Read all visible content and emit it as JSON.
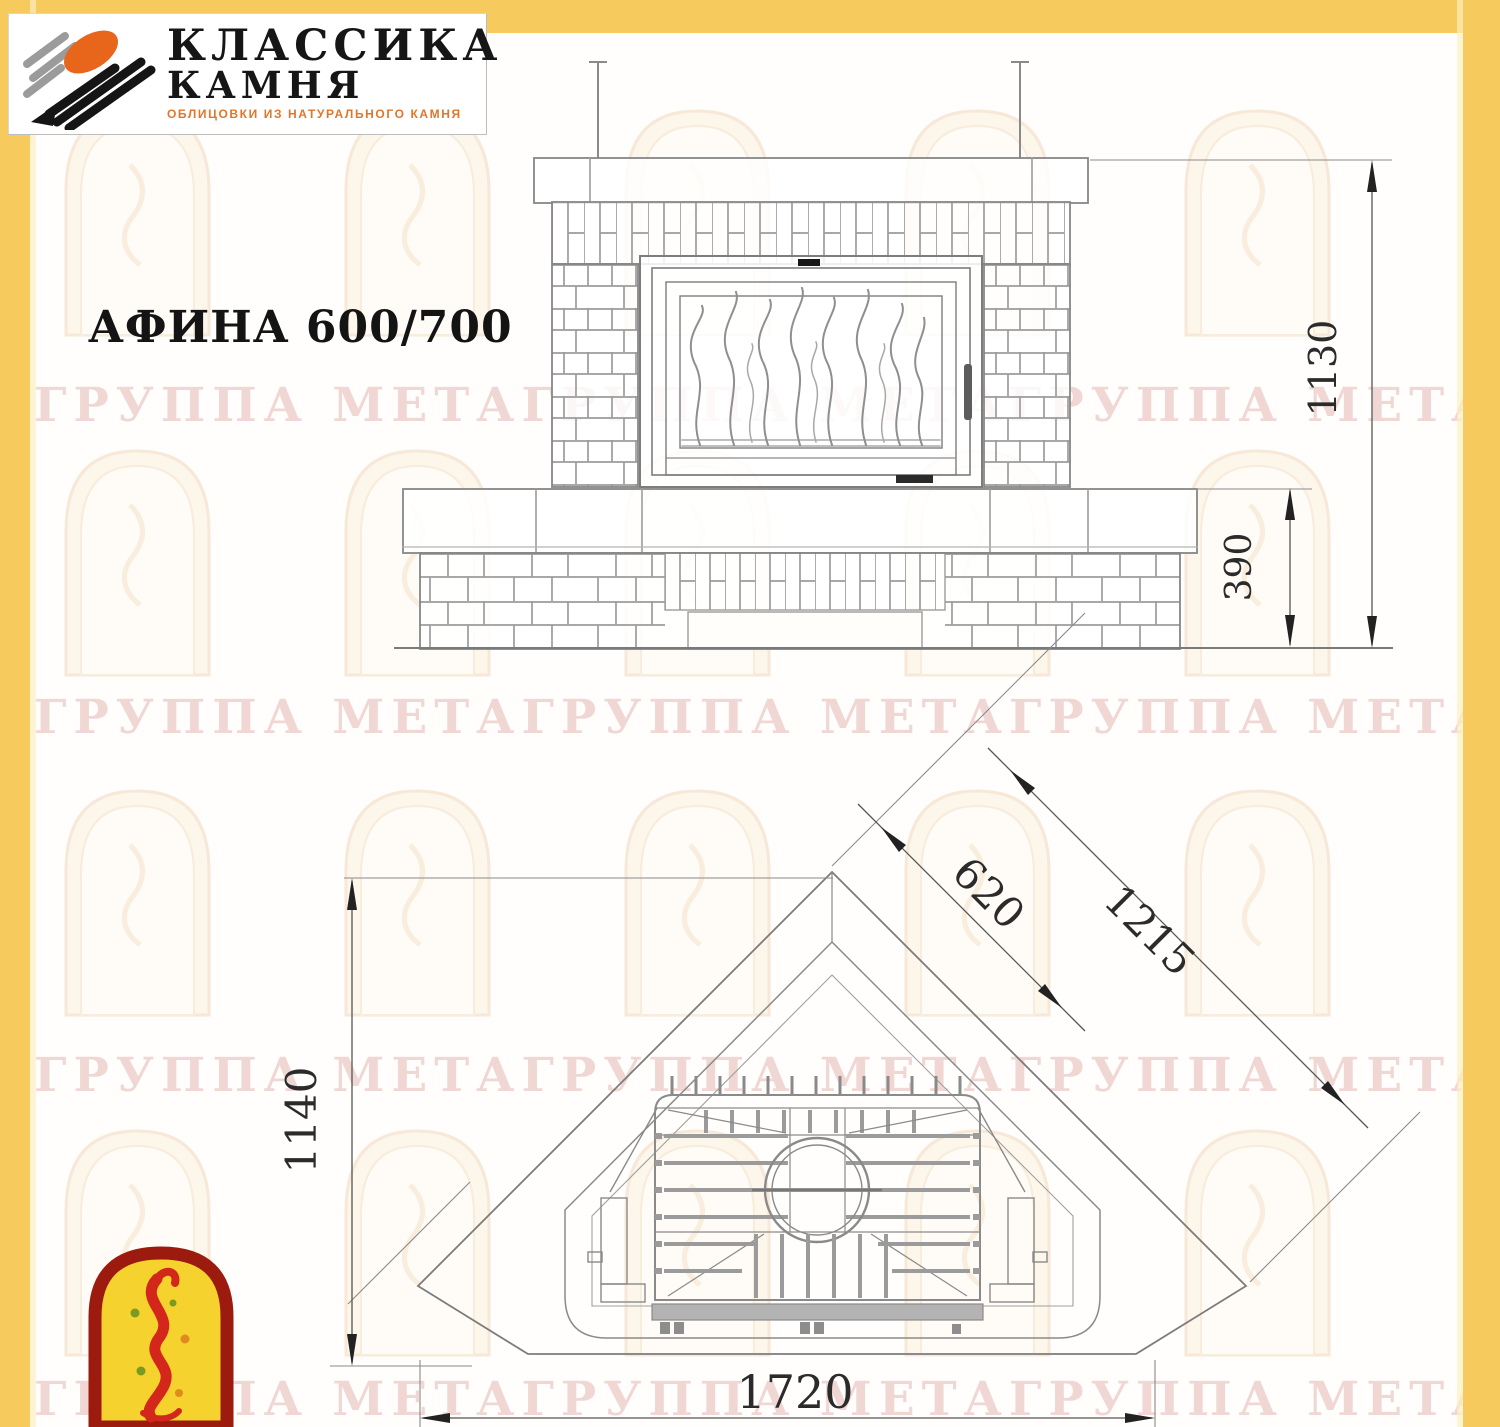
{
  "page": {
    "background": "#fffefd",
    "frame_color": "#f7ca5e"
  },
  "brand": {
    "name_line1": "КЛАССИКА",
    "name_line2": "КАМНЯ",
    "subtitle": "ОБЛИЦОВКИ ИЗ НАТУРАЛЬНОГО КАМНЯ",
    "logo_icon": "stone-strokes-logo-icon",
    "colors": {
      "gray": "#9b9b9b",
      "orange": "#e8651c",
      "black": "#151515",
      "accent_text": "#e0762a"
    }
  },
  "title": "АФИНА 600/700",
  "watermark": {
    "text": "ГРУППА МЕТАГРУППА МЕТАГРУППА МЕТАГРУППА МЕТАГРУППА МЕТА",
    "color": "#d89890"
  },
  "front_view": {
    "label": "front-elevation-of-fireplace",
    "dims": {
      "height_total": "1130",
      "height_base": "390"
    }
  },
  "plan_view": {
    "label": "top-plan-of-corner-fireplace",
    "dims": {
      "firebox_front": "620",
      "face_width": "1215",
      "depth": "1140",
      "width_total": "1720"
    }
  },
  "footer_logo": {
    "icon": "flame-arch-logo-icon",
    "colors": {
      "border": "#9c1a0e",
      "fill": "#f5d22e",
      "flame": "#d2271a"
    }
  }
}
